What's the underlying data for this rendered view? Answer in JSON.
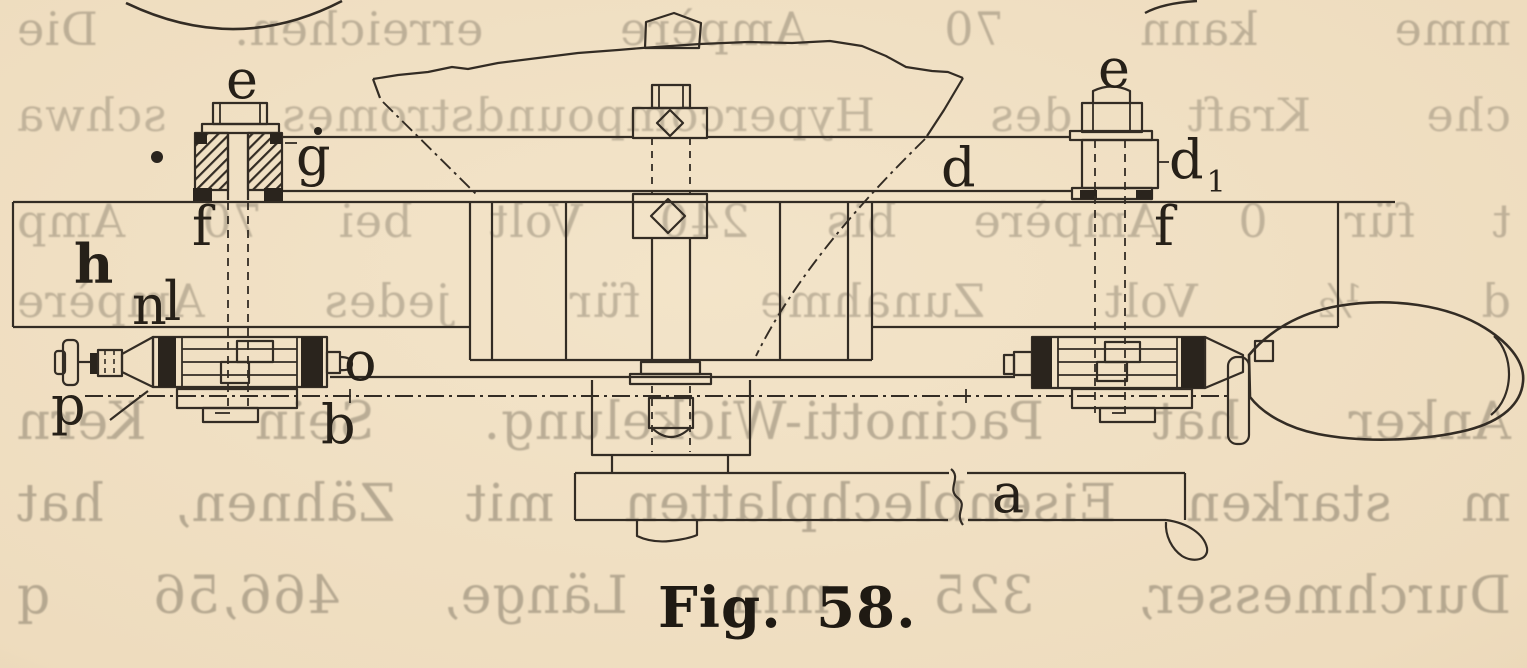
{
  "page": {
    "type": "scanned book page with engraving",
    "paper_color": "#eedcbe",
    "ink_color": "#332c24",
    "figure": {
      "caption": "Fig. 58.",
      "number": "58",
      "part_labels": [
        {
          "id": "e-left",
          "text": "e"
        },
        {
          "id": "g",
          "text": "g"
        },
        {
          "id": "f-left",
          "text": "f"
        },
        {
          "id": "h",
          "text": "h"
        },
        {
          "id": "n",
          "text": "n"
        },
        {
          "id": "l",
          "text": "l"
        },
        {
          "id": "o",
          "text": "o"
        },
        {
          "id": "p",
          "text": "p"
        },
        {
          "id": "b",
          "text": "b"
        },
        {
          "id": "a",
          "text": "a"
        },
        {
          "id": "d",
          "text": "d"
        },
        {
          "id": "d1",
          "text": "d",
          "sub": "1"
        },
        {
          "id": "e-right",
          "text": "e"
        },
        {
          "id": "f-right",
          "text": "f"
        }
      ]
    },
    "bleedthrough": {
      "description": "mirrored show-through text from reverse side of the leaf",
      "color": "#786f5e",
      "lines": [
        {
          "text": "mme kann 70 Ampère erreichen. Die"
        },
        {
          "text": "che Kraft des Hypercompoundstromes schwa"
        },
        {
          "text": "t für 0 Ampère bis 240 Volt bei 70 Amp"
        },
        {
          "text": "d ½ Volt Zunahme für jedes Ampère"
        },
        {
          "text": "Anker hat Pacinotti-Wickelung. Sein Kern"
        },
        {
          "text": "m starken Eisenblechplatten mit Zähnen, hat"
        },
        {
          "text": "Durchmesser, 325 mm Länge, 466,56 q"
        }
      ]
    }
  }
}
